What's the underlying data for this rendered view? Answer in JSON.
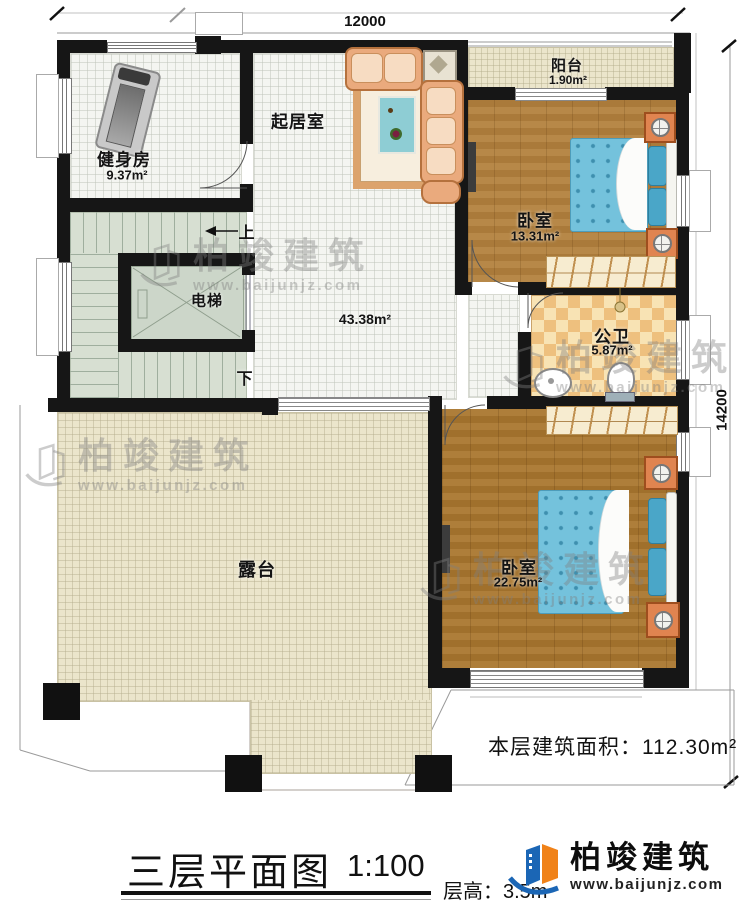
{
  "dimensions": {
    "width": "12000",
    "height": "14200"
  },
  "rooms": {
    "gym": {
      "name": "健身房",
      "area": "9.37m²"
    },
    "living": {
      "name": "起居室",
      "area": "43.38m²"
    },
    "balcony": {
      "name": "阳台",
      "area": "1.90m²"
    },
    "bedroom1": {
      "name": "卧室",
      "area": "13.31m²"
    },
    "bathroom": {
      "name": "公卫",
      "area": "5.87m²"
    },
    "bedroom2": {
      "name": "卧室",
      "area": "22.75m²"
    },
    "terrace": {
      "name": "露台"
    },
    "elevator": {
      "name": "电梯"
    },
    "stairs": {
      "up_label": "上",
      "down_label": "下"
    }
  },
  "annotations": {
    "floor_area": "本层建筑面积：112.30m²",
    "floor_height": "层高：3.5m",
    "title": "三层平面图",
    "scale": "1:100"
  },
  "brand": {
    "name": "柏竣建筑",
    "url": "www.baijunjz.com"
  },
  "watermark": {
    "name": "柏竣建筑",
    "url": "www.baijunjz.com"
  },
  "colors": {
    "wall": "#161616",
    "wood": "#b3813d",
    "terrace": "#ebe5cb",
    "bath_tile": "#eec07e",
    "stair": "#d7dfd2",
    "brand_blue": "#1b66b5",
    "brand_orange": "#f08219"
  }
}
